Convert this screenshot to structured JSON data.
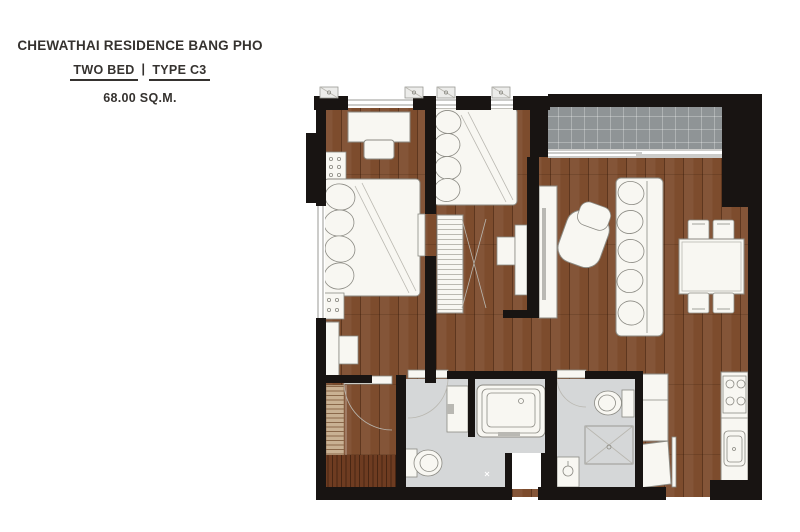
{
  "header": {
    "project_name": "CHEWATHAI RESIDENCE BANG PHO",
    "bed_type": "TWO BED",
    "divider": "|",
    "unit_type": "TYPE C3",
    "area": "68.00 SQ.M."
  },
  "colors": {
    "text": "#35322f",
    "wall": "#181412",
    "wood": "#7d4c2d",
    "balcony": "#8f9496",
    "bath_floor": "#d5d7d8",
    "furn_fill": "#f8f7f2",
    "furn_stroke": "#8b8a83",
    "hatch_light": "#c9b193",
    "hatch_dark": "#6e3c21",
    "background": "#ffffff"
  }
}
